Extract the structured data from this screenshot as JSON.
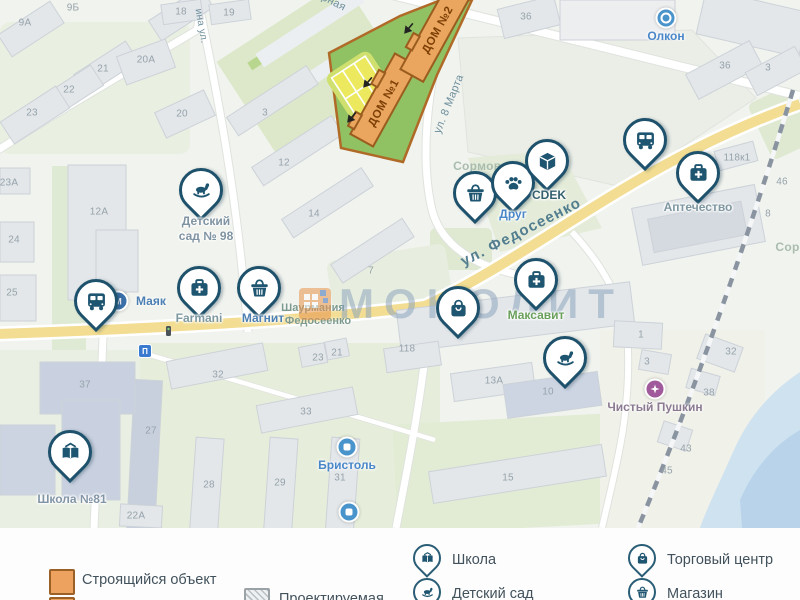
{
  "map": {
    "watermark": {
      "text": "МОНОЛИТ"
    },
    "construction": {
      "dom1": "ДОМ №1",
      "dom2": "ДОМ №2"
    },
    "street_labels": [
      {
        "t": "ул. Федосеенко",
        "x": 521,
        "y": 232,
        "r": -27,
        "s": 15,
        "c": "#527e90",
        "w": 600,
        "ls": 1.2
      },
      {
        "t": "ул. 8 Марта",
        "x": 449,
        "y": 104,
        "r": -68,
        "s": 11,
        "c": "#6e8f9d",
        "w": 400,
        "ls": 0.3
      },
      {
        "t": "ина ул.",
        "x": 201,
        "y": 26,
        "r": 80,
        "s": 10,
        "c": "#6e8f9d",
        "w": 400,
        "ls": 0.3
      },
      {
        "t": "Ударная",
        "x": 325,
        "y": -2,
        "r": 27,
        "s": 11,
        "c": "#6e8f9d",
        "w": 400,
        "ls": 0.3
      },
      {
        "t": "Сормово",
        "x": 481,
        "y": 166,
        "r": 0,
        "s": 12,
        "c": "#a9bcae",
        "w": 600,
        "ls": 0.3
      },
      {
        "t": "Сорм",
        "x": 792,
        "y": 247,
        "r": 0,
        "s": 12,
        "c": "#a9bcae",
        "w": 600,
        "ls": 0.3
      }
    ],
    "poi_text_labels": [
      {
        "t": "Шаурмания",
        "x": 313,
        "y": 308
      },
      {
        "t": "Федосеенко",
        "x": 318,
        "y": 321
      }
    ],
    "building_numbers": [
      {
        "t": "9Б",
        "x": 73,
        "y": 8
      },
      {
        "t": "9А",
        "x": 25,
        "y": 23
      },
      {
        "t": "21",
        "x": 103,
        "y": 69
      },
      {
        "t": "22",
        "x": 69,
        "y": 90
      },
      {
        "t": "23",
        "x": 32,
        "y": 113
      },
      {
        "t": "20А",
        "x": 146,
        "y": 60
      },
      {
        "t": "18",
        "x": 181,
        "y": 12
      },
      {
        "t": "19",
        "x": 229,
        "y": 13
      },
      {
        "t": "20",
        "x": 182,
        "y": 114
      },
      {
        "t": "23А",
        "x": 9,
        "y": 183
      },
      {
        "t": "12А",
        "x": 99,
        "y": 212
      },
      {
        "t": "24",
        "x": 14,
        "y": 240
      },
      {
        "t": "25",
        "x": 12,
        "y": 293
      },
      {
        "t": "3",
        "x": 265,
        "y": 113
      },
      {
        "t": "12",
        "x": 284,
        "y": 163
      },
      {
        "t": "14",
        "x": 314,
        "y": 214
      },
      {
        "t": "7",
        "x": 371,
        "y": 271
      },
      {
        "t": "36",
        "x": 526,
        "y": 17
      },
      {
        "t": "36",
        "x": 725,
        "y": 66
      },
      {
        "t": "3",
        "x": 768,
        "y": 68
      },
      {
        "t": "118к1",
        "x": 737,
        "y": 158
      },
      {
        "t": "46",
        "x": 782,
        "y": 182
      },
      {
        "t": "8",
        "x": 768,
        "y": 214
      },
      {
        "t": "118",
        "x": 407,
        "y": 349
      },
      {
        "t": "13А",
        "x": 494,
        "y": 381
      },
      {
        "t": "10",
        "x": 548,
        "y": 392
      },
      {
        "t": "15",
        "x": 508,
        "y": 478
      },
      {
        "t": "1",
        "x": 641,
        "y": 335
      },
      {
        "t": "3",
        "x": 647,
        "y": 362
      },
      {
        "t": "32",
        "x": 731,
        "y": 352
      },
      {
        "t": "38",
        "x": 709,
        "y": 393
      },
      {
        "t": "43",
        "x": 686,
        "y": 449
      },
      {
        "t": "45",
        "x": 667,
        "y": 471
      },
      {
        "t": "37",
        "x": 85,
        "y": 385
      },
      {
        "t": "32",
        "x": 218,
        "y": 375
      },
      {
        "t": "33",
        "x": 306,
        "y": 412
      },
      {
        "t": "23",
        "x": 318,
        "y": 358
      },
      {
        "t": "21",
        "x": 337,
        "y": 353
      },
      {
        "t": "27",
        "x": 151,
        "y": 431
      },
      {
        "t": "28",
        "x": 209,
        "y": 485
      },
      {
        "t": "29",
        "x": 280,
        "y": 483
      },
      {
        "t": "31",
        "x": 340,
        "y": 478
      },
      {
        "t": "22А",
        "x": 136,
        "y": 516
      }
    ],
    "pins": [
      {
        "icon": "rocking-horse",
        "x": 201,
        "y": 190,
        "label": "Детский\nсад № 98",
        "lx": 206,
        "ly": 214,
        "color": "#7f93a2"
      },
      {
        "icon": "medkit",
        "x": 199,
        "y": 288,
        "label": "Farmani",
        "lx": 199,
        "ly": 311,
        "color": "#7f99a1"
      },
      {
        "icon": "basket",
        "x": 259,
        "y": 288,
        "label": "Магнит",
        "lx": 263,
        "ly": 311,
        "color": "#4c7fb2"
      },
      {
        "icon": "bus",
        "x": 96,
        "y": 301
      },
      {
        "icon": "book",
        "x": 70,
        "y": 452,
        "label": "Школа №81",
        "lx": 72,
        "ly": 492,
        "color": "#8295a6"
      },
      {
        "icon": "basket",
        "x": 475,
        "y": 193
      },
      {
        "icon": "paw",
        "x": 513,
        "y": 183,
        "label": "Друг",
        "lx": 513,
        "ly": 207,
        "color": "#4a87c9"
      },
      {
        "icon": "box",
        "x": 547,
        "y": 161,
        "label": "CDEK",
        "lx": 549,
        "ly": 188,
        "color": "#35616f"
      },
      {
        "icon": "bus",
        "x": 645,
        "y": 140
      },
      {
        "icon": "medkit",
        "x": 698,
        "y": 173,
        "label": "Аптечество",
        "lx": 698,
        "ly": 200,
        "color": "#7e97a0"
      },
      {
        "icon": "medkit",
        "x": 536,
        "y": 280,
        "label": "Максавит",
        "lx": 536,
        "ly": 308,
        "color": "#6aa05b"
      },
      {
        "icon": "bag",
        "x": 458,
        "y": 308
      },
      {
        "icon": "rocking-horse",
        "x": 565,
        "y": 358
      }
    ],
    "dots": [
      {
        "x": 118,
        "y": 301,
        "bg": "#3b6fa8",
        "glyph": "М",
        "label": "Маяк",
        "lx": 136,
        "ly": 294,
        "lcolor": "#4c7fb2",
        "align": "left"
      },
      {
        "x": 666,
        "y": 18,
        "bg": "#4a94cc",
        "glyph": "ring",
        "label": "Олкон",
        "lx": 666,
        "ly": 29,
        "lcolor": "#4a87c9",
        "align": "center"
      },
      {
        "x": 347,
        "y": 447,
        "bg": "#4a94cc",
        "glyph": "sq",
        "label": "Бристоль",
        "lx": 347,
        "ly": 458,
        "lcolor": "#4a87c9",
        "align": "center"
      },
      {
        "x": 349,
        "y": 512,
        "bg": "#4a94cc",
        "glyph": "sq"
      },
      {
        "x": 655,
        "y": 389,
        "bg": "#a05a9b",
        "glyph": "flower",
        "label": "Чистый Пушкин",
        "lx": 655,
        "ly": 400,
        "lcolor": "#8b7b92",
        "align": "center"
      }
    ],
    "signs": [
      {
        "t": "П",
        "x": 145,
        "y": 351
      }
    ]
  },
  "legend": {
    "swatch_items": [
      {
        "type": "construction",
        "label": "Строящийся объект",
        "sx": 49,
        "sy": 569,
        "lx": 82,
        "ly": 580
      },
      {
        "type": "projected",
        "label": "Проектируемая",
        "sx": 244,
        "sy": 588,
        "lx": 279,
        "ly": 599
      }
    ],
    "clipped_swatch": {
      "type": "construction2",
      "sx": 49,
      "sy": 597
    },
    "pin_items": [
      {
        "icon": "book",
        "label": "Школа",
        "x": 427,
        "y": 558,
        "lx": 452,
        "ly": 560
      },
      {
        "icon": "rocking-horse",
        "label": "Детский сад",
        "x": 427,
        "y": 592,
        "lx": 452,
        "ly": 594
      },
      {
        "icon": "bag",
        "label": "Торговый центр",
        "x": 642,
        "y": 558,
        "lx": 667,
        "ly": 560
      },
      {
        "icon": "basket",
        "label": "Магазин",
        "x": 642,
        "y": 592,
        "lx": 667,
        "ly": 594
      }
    ]
  }
}
